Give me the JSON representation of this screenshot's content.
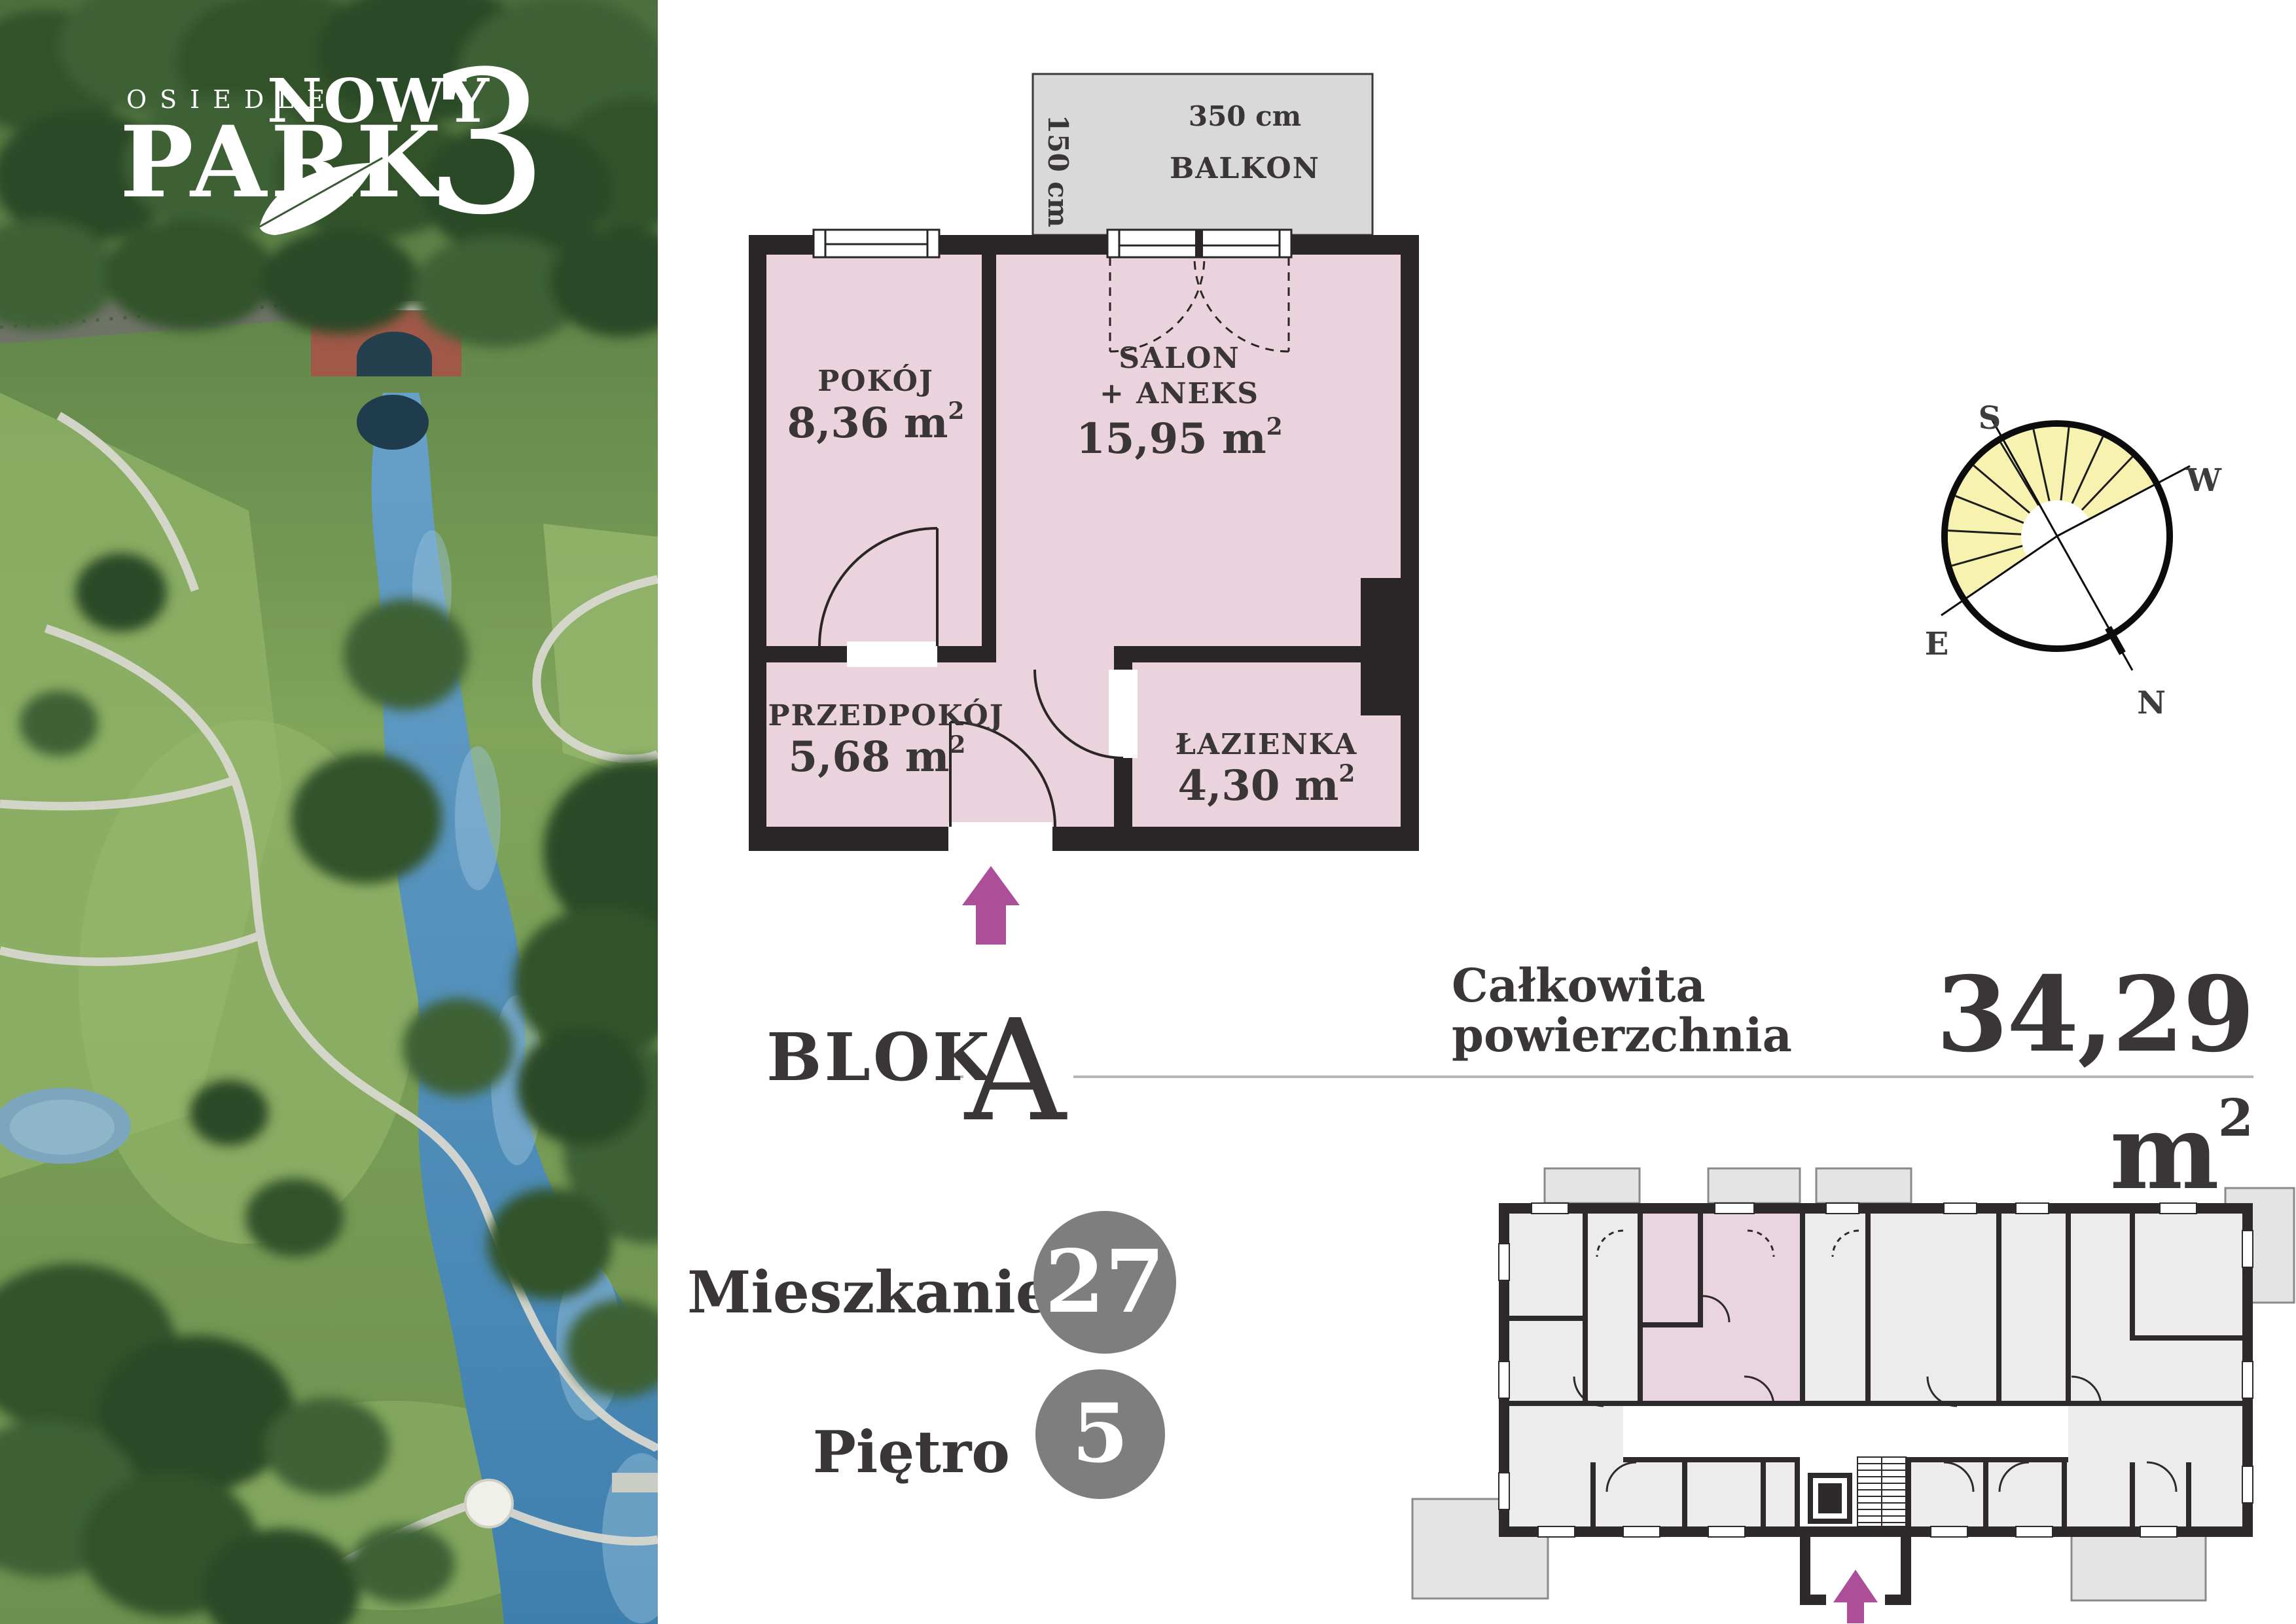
{
  "colors": {
    "room_fill": "#ebd3de",
    "wall": "#2a2627",
    "balcony_fill": "#d9d9d9",
    "building_room_fill": "#ececec",
    "arrow": "#ad4e98",
    "compass_sun": "#f8f2b0",
    "badge": "#7e7e7e",
    "text": "#3a3536",
    "rule": "#b5b5b5"
  },
  "logo": {
    "estate": "OSIEDLE",
    "name_line1": "NOWY",
    "name_line2": "PARK",
    "number": "3"
  },
  "plan": {
    "balcony": {
      "name": "BALKON",
      "width": "350 cm",
      "depth": "150 cm"
    },
    "rooms": [
      {
        "name": "POKÓJ",
        "area": "8,36 m",
        "area_sup": "2"
      },
      {
        "name_line1": "SALON",
        "name_line2": "+ ANEKS",
        "area": "15,95 m",
        "area_sup": "2"
      },
      {
        "name": "PRZEDPOKÓJ",
        "area": "5,68 m",
        "area_sup": "2"
      },
      {
        "name": "ŁAZIENKA",
        "area": "4,30 m",
        "area_sup": "2"
      }
    ]
  },
  "compass": {
    "south": "S",
    "west": "W",
    "east": "E",
    "north": "N"
  },
  "block": {
    "label": "BLOK",
    "value": "A"
  },
  "total_area": {
    "label_line1": "Całkowita",
    "label_line2": "powierzchnia",
    "value": "34,29 m",
    "value_sup": "2"
  },
  "apartment": {
    "label": "Mieszkanie",
    "value": "27"
  },
  "floor": {
    "label": "Piętro",
    "value": "5"
  }
}
